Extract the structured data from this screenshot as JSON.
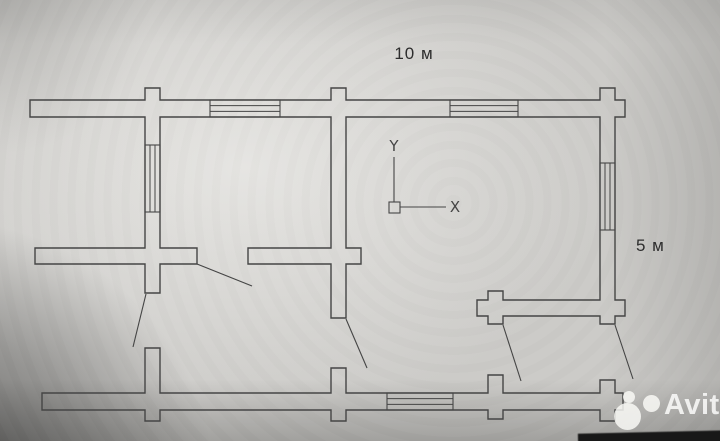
{
  "labels": {
    "width": "10 м",
    "height": "5 м"
  },
  "watermark": {
    "text": "Avito"
  },
  "plan": {
    "stroke": "#454545",
    "ucs_stroke": "#4f4f4f",
    "wall_polygons": [
      [
        [
          30,
          100
        ],
        [
          145,
          100
        ],
        [
          145,
          88
        ],
        [
          160,
          88
        ],
        [
          160,
          100
        ],
        [
          331,
          100
        ],
        [
          331,
          88
        ],
        [
          346,
          88
        ],
        [
          346,
          100
        ],
        [
          600,
          100
        ],
        [
          600,
          88
        ],
        [
          615,
          88
        ],
        [
          615,
          100
        ],
        [
          625,
          100
        ],
        [
          625,
          117
        ],
        [
          615,
          117
        ],
        [
          615,
          300
        ],
        [
          625,
          300
        ],
        [
          625,
          316
        ],
        [
          615,
          316
        ],
        [
          615,
          324
        ],
        [
          600,
          324
        ],
        [
          600,
          316
        ],
        [
          503,
          316
        ],
        [
          503,
          324
        ],
        [
          488,
          324
        ],
        [
          488,
          316
        ],
        [
          477,
          316
        ],
        [
          477,
          300
        ],
        [
          488,
          300
        ],
        [
          488,
          291
        ],
        [
          503,
          291
        ],
        [
          503,
          300
        ],
        [
          600,
          300
        ],
        [
          600,
          117
        ],
        [
          346,
          117
        ],
        [
          346,
          248
        ],
        [
          361,
          248
        ],
        [
          361,
          264
        ],
        [
          346,
          264
        ],
        [
          346,
          318
        ],
        [
          331,
          318
        ],
        [
          331,
          264
        ],
        [
          248,
          264
        ],
        [
          248,
          248
        ],
        [
          331,
          248
        ],
        [
          331,
          117
        ],
        [
          160,
          117
        ],
        [
          160,
          248
        ],
        [
          197,
          248
        ],
        [
          197,
          264
        ],
        [
          160,
          264
        ],
        [
          160,
          293
        ],
        [
          145,
          293
        ],
        [
          145,
          264
        ],
        [
          35,
          264
        ],
        [
          35,
          248
        ],
        [
          145,
          248
        ],
        [
          145,
          117
        ],
        [
          30,
          117
        ]
      ],
      [
        [
          42,
          393
        ],
        [
          145,
          393
        ],
        [
          145,
          348
        ],
        [
          160,
          348
        ],
        [
          160,
          393
        ],
        [
          331,
          393
        ],
        [
          331,
          368
        ],
        [
          346,
          368
        ],
        [
          346,
          393
        ],
        [
          488,
          393
        ],
        [
          488,
          375
        ],
        [
          503,
          375
        ],
        [
          503,
          393
        ],
        [
          600,
          393
        ],
        [
          600,
          380
        ],
        [
          615,
          380
        ],
        [
          615,
          393
        ],
        [
          623,
          393
        ],
        [
          623,
          410
        ],
        [
          615,
          410
        ],
        [
          615,
          421
        ],
        [
          600,
          421
        ],
        [
          600,
          410
        ],
        [
          503,
          410
        ],
        [
          503,
          419
        ],
        [
          488,
          419
        ],
        [
          488,
          410
        ],
        [
          346,
          410
        ],
        [
          346,
          421
        ],
        [
          331,
          421
        ],
        [
          331,
          410
        ],
        [
          160,
          410
        ],
        [
          160,
          421
        ],
        [
          145,
          421
        ],
        [
          145,
          410
        ],
        [
          42,
          410
        ]
      ]
    ],
    "windows": [
      {
        "x": 210,
        "y": 100,
        "w": 70,
        "h": 17,
        "o": "h"
      },
      {
        "x": 450,
        "y": 100,
        "w": 68,
        "h": 17,
        "o": "h"
      },
      {
        "x": 387,
        "y": 393,
        "w": 66,
        "h": 17,
        "o": "h"
      },
      {
        "x": 145,
        "y": 145,
        "w": 15,
        "h": 67,
        "o": "v"
      },
      {
        "x": 600,
        "y": 163,
        "w": 15,
        "h": 67,
        "o": "v"
      }
    ],
    "door_leaves": [
      [
        197,
        264,
        252,
        286
      ],
      [
        146,
        294,
        133,
        347
      ],
      [
        346,
        319,
        367,
        368
      ],
      [
        503,
        325,
        521,
        381
      ],
      [
        615,
        325,
        633,
        379
      ]
    ],
    "ucs": {
      "y_label": "Y",
      "x_label": "X",
      "box": [
        389,
        202,
        11,
        11
      ],
      "y_axis": [
        394,
        157,
        394,
        202
      ],
      "x_axis": [
        400,
        207,
        446,
        207
      ],
      "y_label_pos": [
        394,
        151
      ],
      "x_label_pos": [
        455,
        212
      ]
    }
  }
}
